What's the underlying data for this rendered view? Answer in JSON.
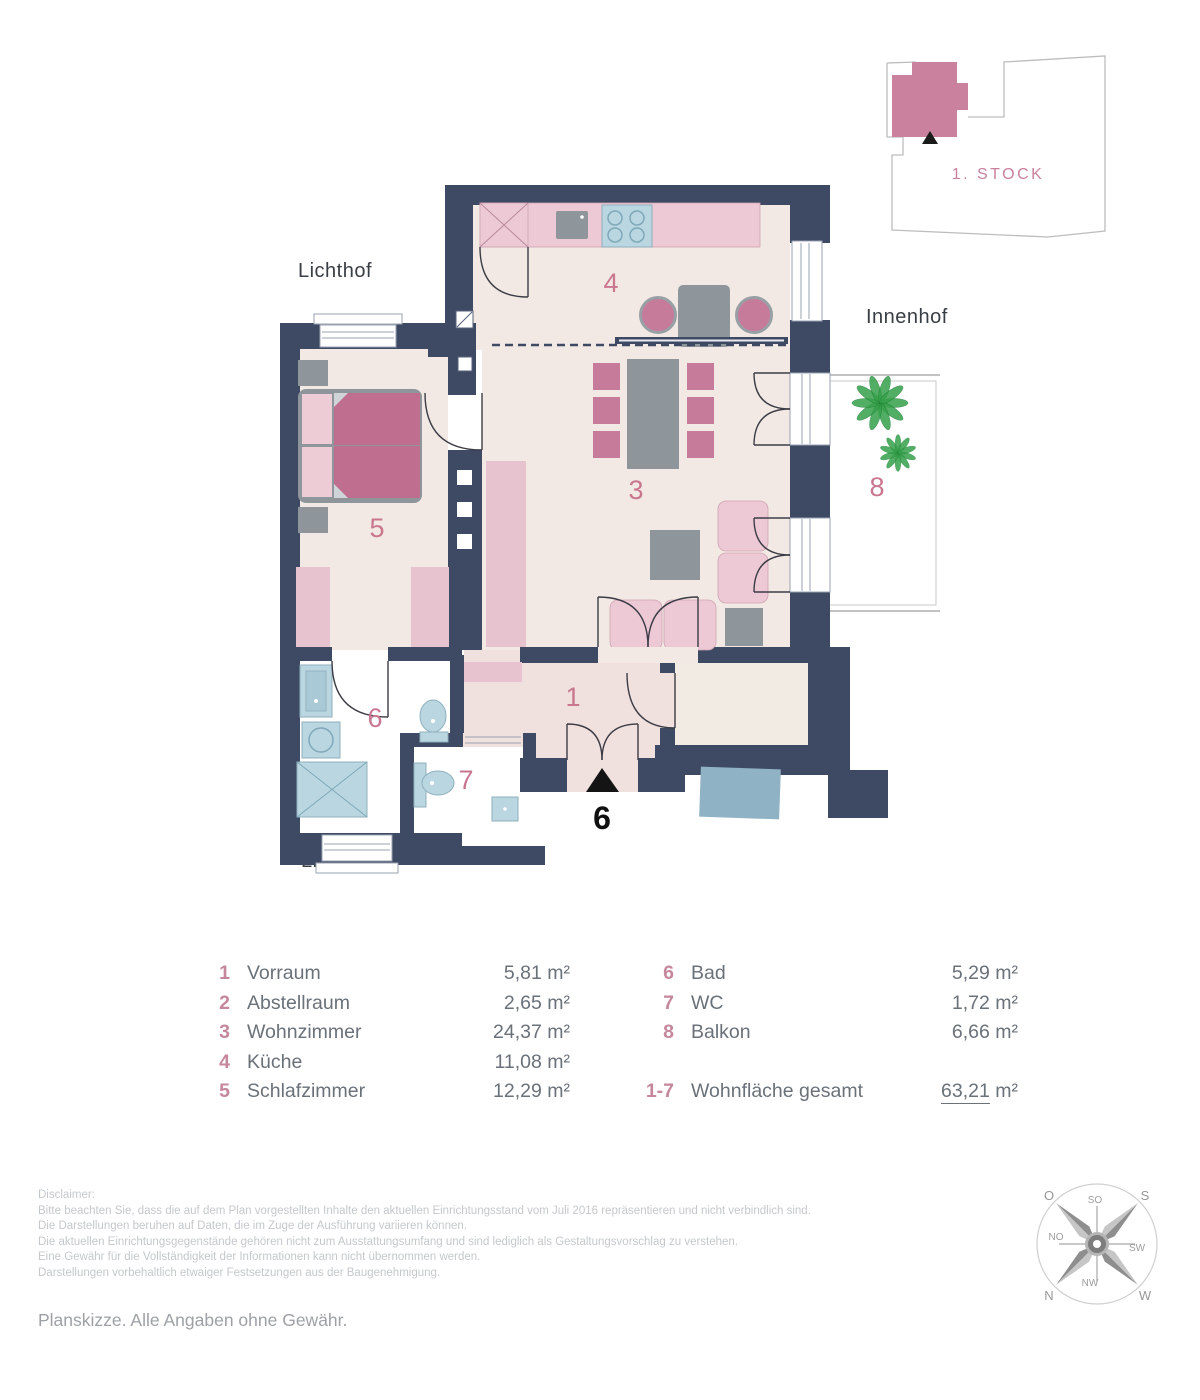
{
  "floor_overview": {
    "label": "1. STOCK"
  },
  "plan": {
    "labels": {
      "courtyard_top": "Lichthof",
      "courtyard_right": "Innenhof",
      "courtyard_bottom": "Lichthof"
    },
    "entrance": {
      "door_number": "6"
    },
    "room_numbers": {
      "vorraum": "1",
      "wohnzimmer": "3",
      "kueche": "4",
      "schlafzimmer": "5",
      "bad": "6",
      "wc": "7",
      "balkon": "8"
    }
  },
  "legend": {
    "left": [
      {
        "num": "1",
        "name": "Vorraum",
        "area": "5,81 m²"
      },
      {
        "num": "2",
        "name": "Abstellraum",
        "area": "2,65 m²"
      },
      {
        "num": "3",
        "name": "Wohnzimmer",
        "area": "24,37 m²"
      },
      {
        "num": "4",
        "name": "Küche",
        "area": "11,08 m²"
      },
      {
        "num": "5",
        "name": "Schlafzimmer",
        "area": "12,29 m²"
      }
    ],
    "right": [
      {
        "num": "6",
        "name": "Bad",
        "area": "5,29 m²"
      },
      {
        "num": "7",
        "name": "WC",
        "area": "1,72 m²"
      },
      {
        "num": "8",
        "name": "Balkon",
        "area": "6,66 m²"
      }
    ],
    "total": {
      "num": "1-7",
      "name": "Wohnfläche gesamt",
      "value": "63,21",
      "unit": " m²"
    }
  },
  "disclaimer": {
    "heading": "Disclaimer:",
    "lines": [
      "Bitte beachten Sie, dass die auf dem Plan vorgestellten Inhalte den aktuellen Einrichtungsstand vom Juli 2016 repräsentieren und nicht verbindlich sind.",
      "Die Darstellungen beruhen auf Daten, die im Zuge der Ausführung variieren können.",
      "Die aktuellen Einrichtungsgegenstände gehören nicht zum Ausstattungsumfang und sind lediglich als Gestaltungsvorschlag zu verstehen.",
      "Eine Gewähr für die Vollständigkeit der Informationen kann nicht übernommen werden.",
      "Darstellungen vorbehaltlich etwaiger Festsetzungen aus der Baugenehmigung."
    ]
  },
  "footer": {
    "note": "Planskizze. Alle Angaben ohne Gewähr."
  },
  "compass": {
    "n": "N",
    "no": "NO",
    "o": "O",
    "so": "SO",
    "s": "S",
    "sw": "SW",
    "w": "W",
    "nw": "NW"
  },
  "colors": {
    "wall": "#3e4a63",
    "floor": "#f3e9e4",
    "floor_pink": "#f0e1de",
    "accent_pink": "#c9768f",
    "pinkl": "#ecc9d4",
    "pinkd": "#c06e90",
    "chair_pink": "#c77b9b",
    "gray": "#8e969b",
    "blue": "#b9d6e1",
    "mat": "#8fb3c5",
    "green": "#35a04a",
    "unit_pink": "#c9819d"
  }
}
